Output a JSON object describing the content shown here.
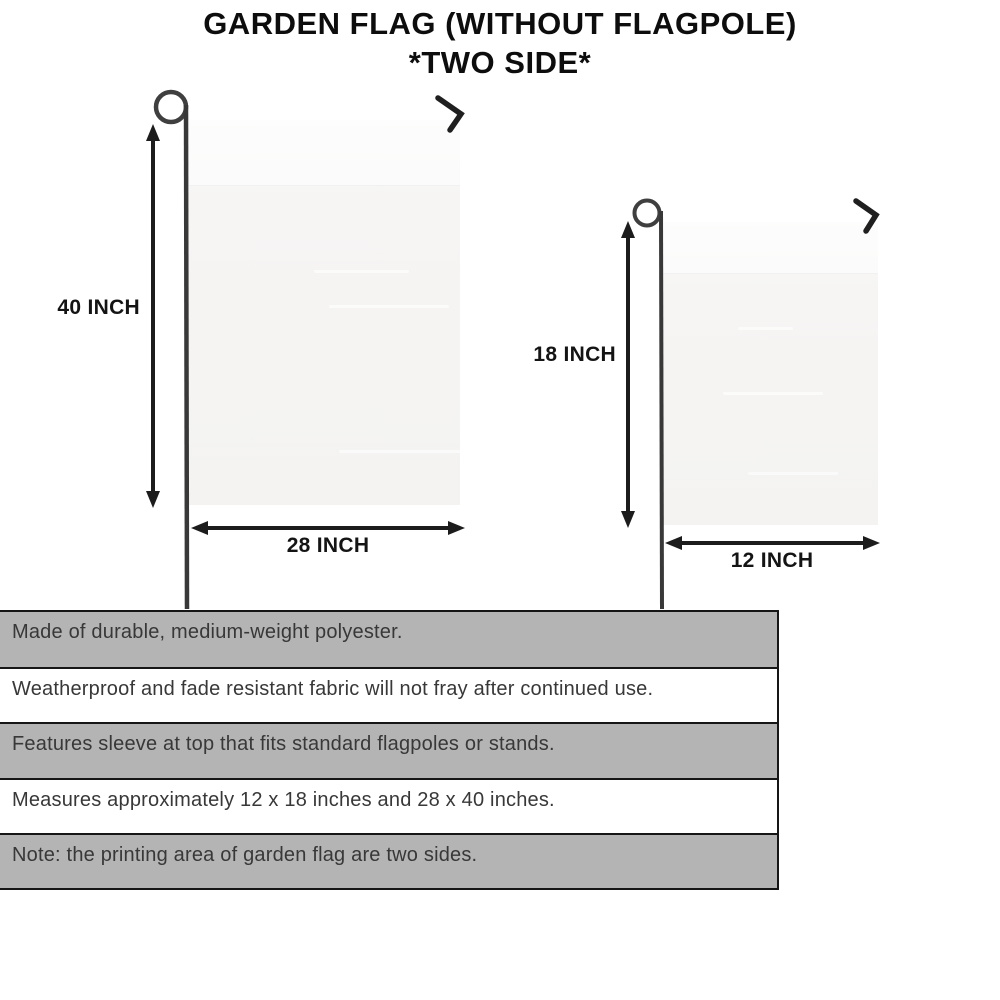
{
  "title": {
    "line1": "GARDEN FLAG (WITHOUT FLAGPOLE)",
    "line2": "*TWO SIDE*"
  },
  "large_flag": {
    "height_label": "40 INCH",
    "width_label": "28 INCH"
  },
  "small_flag": {
    "height_label": "18 INCH",
    "width_label": "12 INCH"
  },
  "features": [
    {
      "text": "Made of durable, medium-weight polyester.",
      "background": "gray"
    },
    {
      "text": "Weatherproof and fade resistant fabric will not fray after continued use.",
      "background": "white"
    },
    {
      "text": "Features sleeve at top that fits standard flagpoles or stands.",
      "background": "gray"
    },
    {
      "text": "Measures approximately 12 x 18 inches and 28 x 40 inches.",
      "background": "white"
    },
    {
      "text": "Note: the printing area of garden flag are two sides.",
      "background": "gray"
    }
  ],
  "colors": {
    "bar_gray": "#b4b4b4",
    "bar_white": "#ffffff",
    "flag_fill": "#f5f4f2",
    "ink": "#1c1c1c",
    "feature_text": "#383838"
  }
}
